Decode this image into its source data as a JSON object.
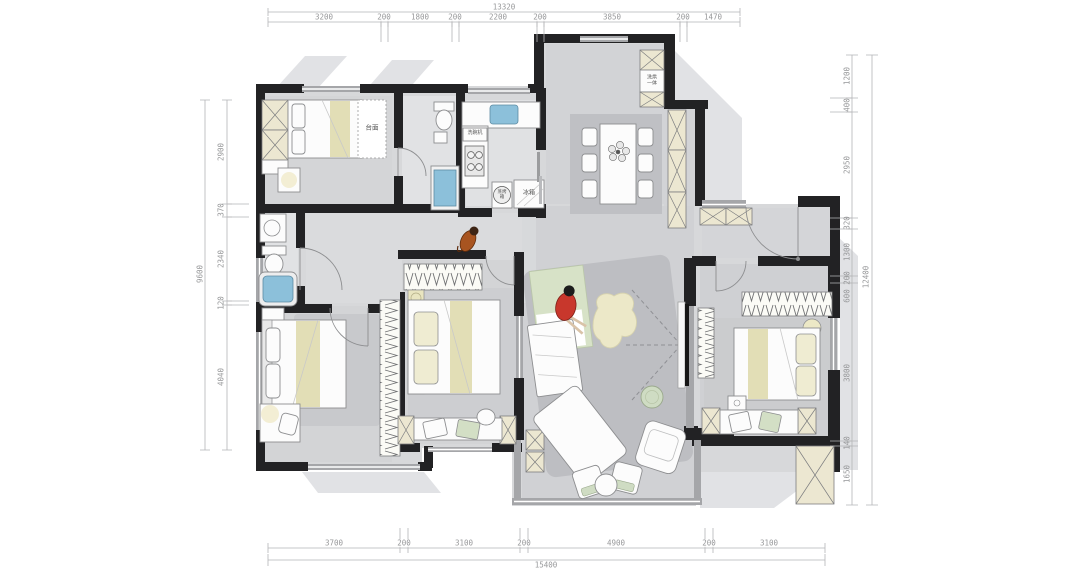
{
  "dimensions": {
    "top": {
      "total": "13320",
      "segments": [
        "3200",
        "200",
        "1800",
        "200",
        "2200",
        "200",
        "3850",
        "200",
        "1470"
      ]
    },
    "bottom": {
      "total": "15400",
      "segments": [
        "3700",
        "200",
        "3100",
        "200",
        "4900",
        "200",
        "3100"
      ]
    },
    "left": {
      "total": "9600",
      "segments": [
        "2900",
        "370",
        "2340",
        "120",
        "4040"
      ]
    },
    "right": {
      "total": "12400",
      "segments": [
        "1200",
        "400",
        "2950",
        "320",
        "1300",
        "200",
        "600",
        "3800",
        "140",
        "1650"
      ]
    }
  },
  "labels": {
    "countertop": "台面",
    "dishwasher": "洗碗机",
    "fridge": "冰箱",
    "steam_oven": "蒸烤箱",
    "washer_dryer": "洗烘一体"
  },
  "colors": {
    "wall": "#222224",
    "floor": "#d7d8da",
    "water": "#8cc0da",
    "accent_beige": "#e2deb6",
    "accent_green": "#cfdcc3",
    "person_red": "#c8372c",
    "dim_text": "#97989a"
  }
}
